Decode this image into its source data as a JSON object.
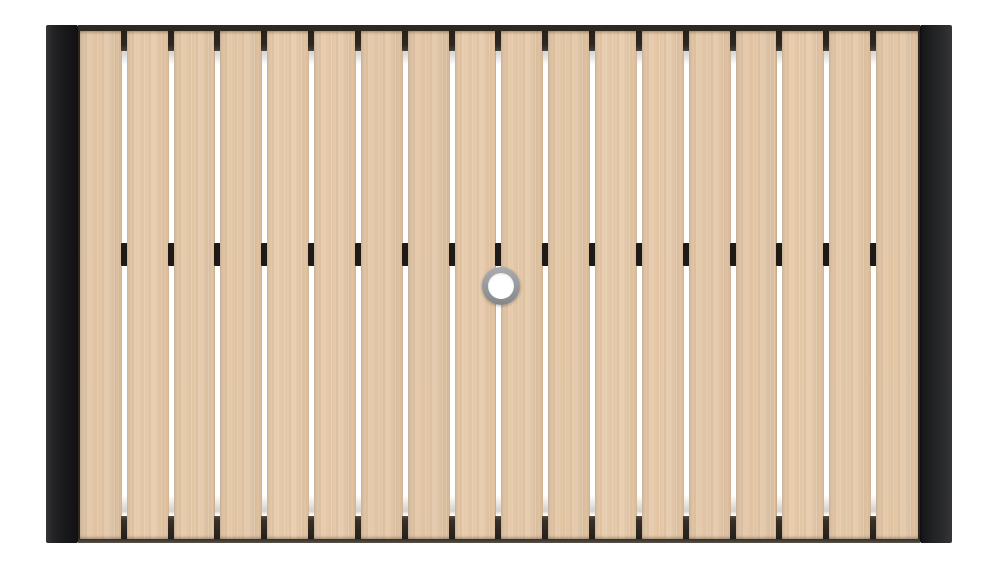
{
  "scene": {
    "type": "product-photo",
    "subject": "Top-down view of a rectangular outdoor patio table with a light wood-look slatted top, black end caps on the left and right, and a central umbrella hole with a gray metal ring",
    "background_color": "#ffffff"
  },
  "table": {
    "slat_count": 18,
    "gap_count": 17,
    "clip_rows": 1,
    "colors": {
      "wood_base": "#e9cba9",
      "wood_light_streak": "#f3dec3",
      "wood_dark_streak": "#dcb992",
      "frame_edge": "#2e2821",
      "end_cap_dark": "#161617",
      "end_cap_light": "#353638",
      "gap_white": "#ffffff",
      "gap_gray": "#d8d8d8",
      "clip": "#1f1a15"
    }
  },
  "umbrella_hole": {
    "ring_color": "#9b9c9f",
    "inner_color": "#ffffff",
    "outer_diameter_px": 38,
    "ring_thickness_px": 6
  }
}
